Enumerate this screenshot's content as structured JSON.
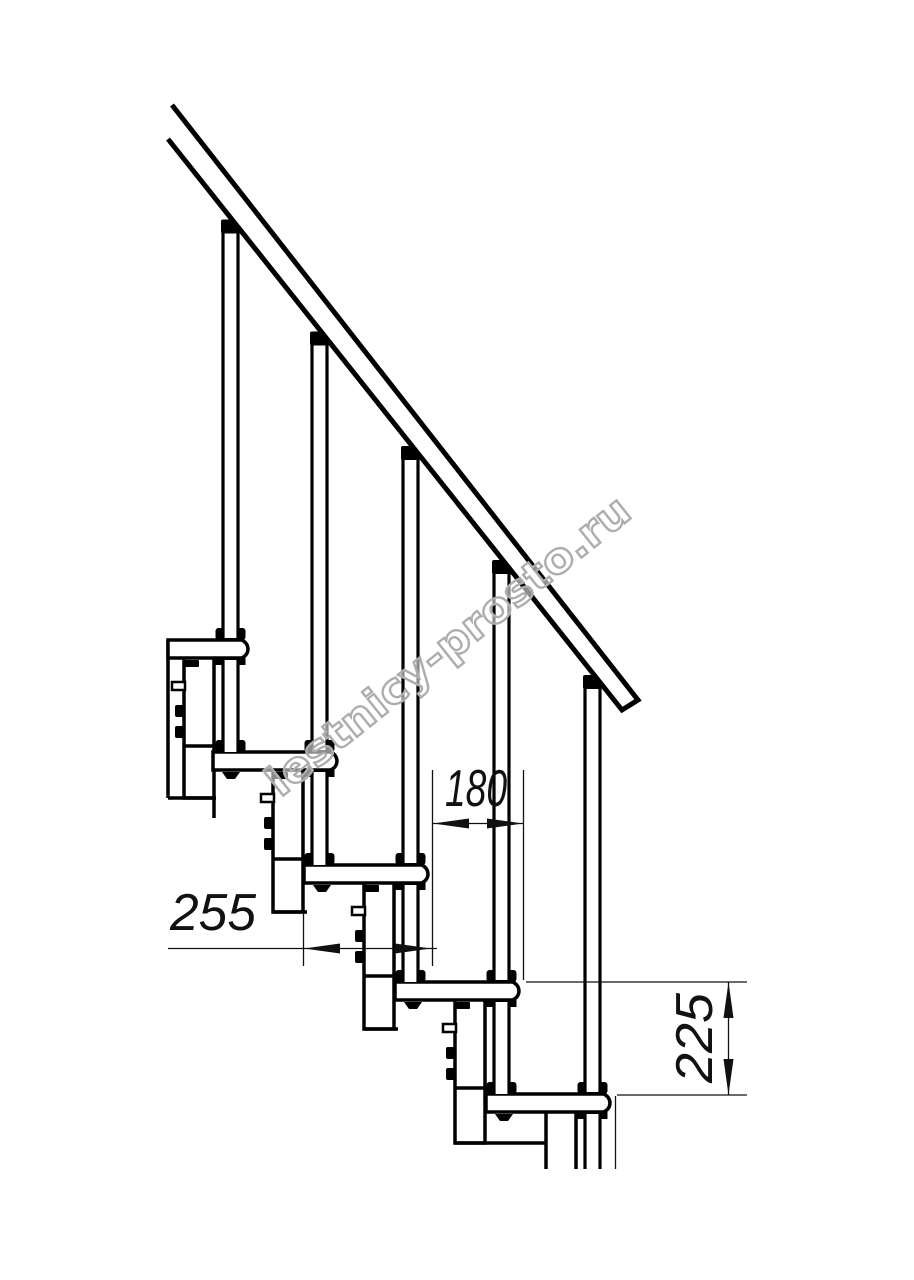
{
  "drawing": {
    "title": "Modular staircase side-view technical drawing",
    "dimensions": {
      "tread_depth": "255",
      "step_run": "180",
      "step_rise": "225"
    },
    "watermark": {
      "text": "lestnicy-prosto.ru",
      "color": "#adadad"
    },
    "colors": {
      "line": "#000000",
      "background": "#ffffff",
      "dimension": "#111111"
    }
  }
}
